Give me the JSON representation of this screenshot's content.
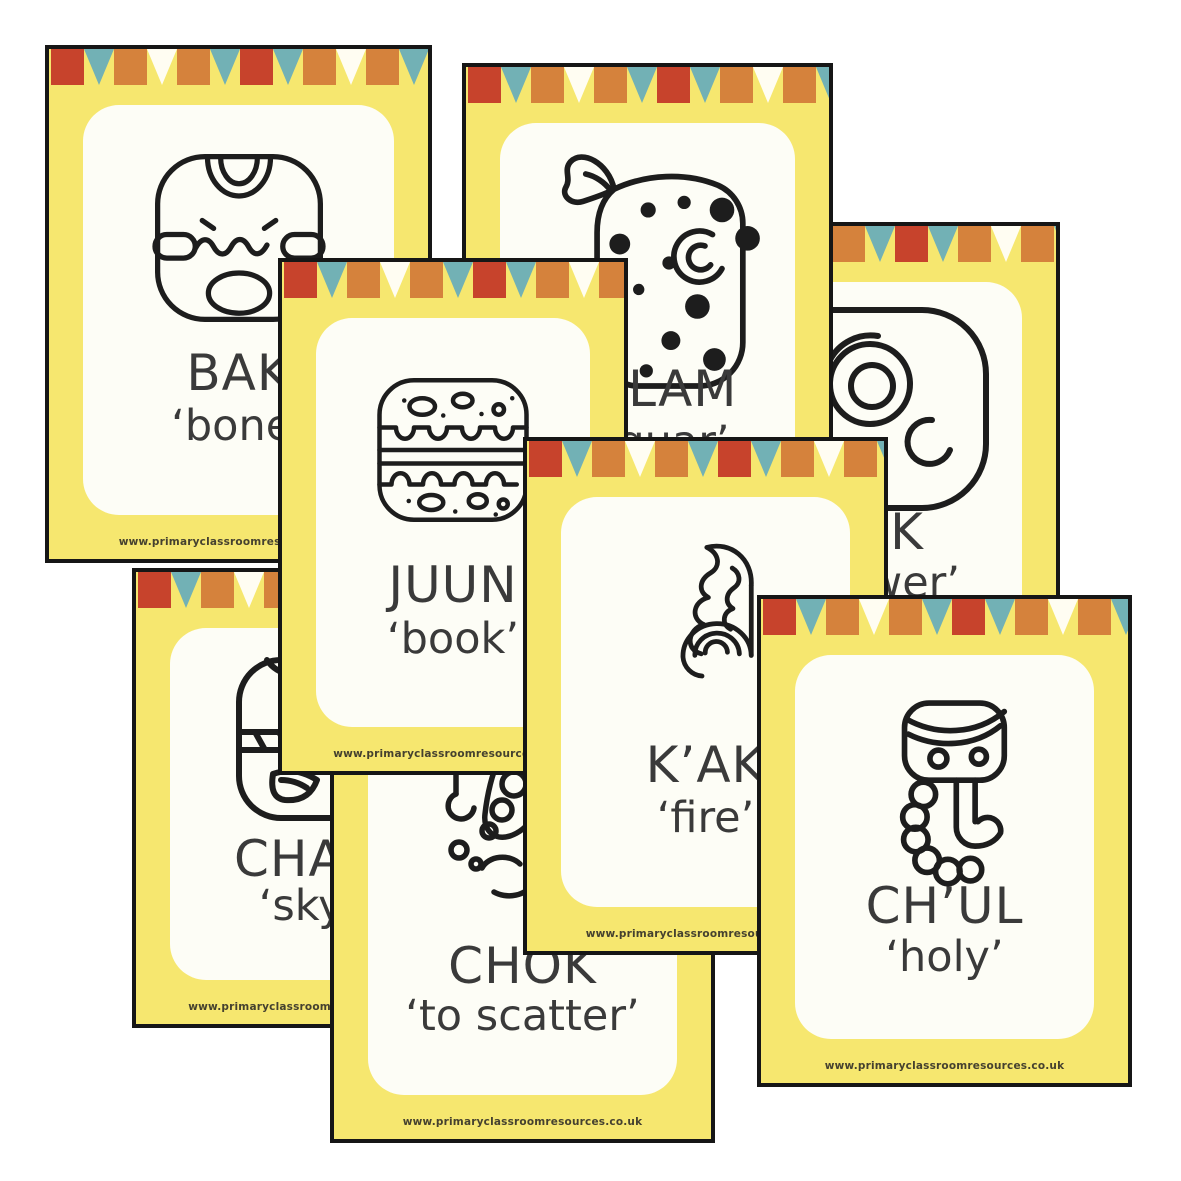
{
  "product": {
    "description": "Mayan glyph flashcards fanned out",
    "footer_url": "www.primaryclassroomresources.co.uk"
  },
  "colors": {
    "card_yellow": "#f6e76f",
    "border_black": "#161616",
    "panel_white": "#fdfdf6",
    "bunting_red": "#c7432c",
    "bunting_orange": "#d5823c",
    "bunting_teal": "#72b1b5",
    "bunting_white": "#fffdf2",
    "text_dark": "#3a3a3a",
    "url_text": "#45412f"
  },
  "bunting_pattern": [
    "red-square",
    "teal-triangle",
    "orange-square",
    "white-triangle",
    "orange-square",
    "teal-triangle"
  ],
  "cards": [
    {
      "id": "nik",
      "word": "NIK",
      "meaning": "‘flower’",
      "glyph_name": "flower-head-glyph"
    },
    {
      "id": "bak",
      "word": "BAK",
      "meaning": "‘bone’",
      "glyph_name": "bone-skull-glyph"
    },
    {
      "id": "balam",
      "word": "BALAM",
      "meaning": "‘jaguar’",
      "glyph_name": "jaguar-glyph"
    },
    {
      "id": "chan",
      "word": "CHAN",
      "meaning": "‘sky’",
      "glyph_name": "sky-glyph"
    },
    {
      "id": "chok",
      "word": "CHOK",
      "meaning": "‘to scatter’",
      "glyph_name": "scatter-hand-glyph"
    },
    {
      "id": "juun",
      "word": "JUUN",
      "meaning": "‘book’",
      "glyph_name": "codex-book-glyph"
    },
    {
      "id": "kak",
      "word": "K’AK",
      "meaning": "‘fire’",
      "glyph_name": "fire-flame-glyph"
    },
    {
      "id": "chul",
      "word": "CH’UL",
      "meaning": "‘holy’",
      "glyph_name": "holy-drops-glyph"
    }
  ]
}
